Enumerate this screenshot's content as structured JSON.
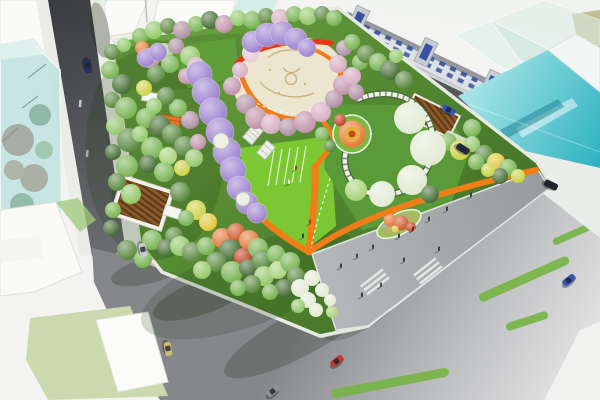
{
  "scene": {
    "type": "aerial-3d-render",
    "subject": "urban-pocket-park-masterplan-with-surrounding-streets"
  },
  "palette": {
    "background": "#f3f4f1",
    "sidewalk": "#ebece7",
    "building_white": "#fafaf8",
    "building_gray": "#c3c7ca",
    "window_blue": "#35539e",
    "glass_teal_light": "#b7e2de",
    "plaza_cream": "#ece5d0",
    "path_orange": "#f07d18",
    "path_red": "#e63614",
    "lawn_bright": "#7cc832",
    "stripe_green": "#76b544",
    "trellis_white": "#eef0e8",
    "trees": {
      "g1": "#6fae46",
      "g2": "#4e8032",
      "g3": "#8cc45e",
      "g4": "#3a6326",
      "g5": "#a4cf70",
      "y1": "#c9ce38",
      "y2": "#dfc22e",
      "o1": "#e2702a",
      "o2": "#c94e1c",
      "r1": "#bf3416",
      "p1": "#d5a6bc",
      "p2": "#bd8aa4",
      "p3": "#e6c6d6",
      "m1": "#a9879e",
      "w1": "#dfe8d0",
      "v1": "#9678cc"
    }
  },
  "park": {
    "trees": [
      [
        112,
        52,
        8,
        "g2"
      ],
      [
        124,
        45,
        7,
        "g3"
      ],
      [
        110,
        70,
        9,
        "g1"
      ],
      [
        122,
        84,
        10,
        "g4"
      ],
      [
        112,
        100,
        8,
        "g2"
      ],
      [
        126,
        108,
        11,
        "g1"
      ],
      [
        115,
        126,
        9,
        "g3"
      ],
      [
        129,
        140,
        12,
        "g2"
      ],
      [
        113,
        152,
        8,
        "g4"
      ],
      [
        127,
        166,
        11,
        "g1"
      ],
      [
        117,
        182,
        9,
        "g2"
      ],
      [
        131,
        194,
        10,
        "g3"
      ],
      [
        113,
        210,
        8,
        "g1"
      ],
      [
        111,
        228,
        8,
        "g4"
      ],
      [
        127,
        250,
        10,
        "g2"
      ],
      [
        143,
        259,
        9,
        "g1"
      ],
      [
        140,
        36,
        8,
        "g1"
      ],
      [
        154,
        30,
        9,
        "g3"
      ],
      [
        168,
        26,
        8,
        "g2"
      ],
      [
        182,
        30,
        9,
        "m1"
      ],
      [
        196,
        24,
        8,
        "g1"
      ],
      [
        210,
        20,
        9,
        "g4"
      ],
      [
        224,
        24,
        9,
        "p2"
      ],
      [
        238,
        18,
        8,
        "g3"
      ],
      [
        252,
        20,
        9,
        "g1"
      ],
      [
        266,
        16,
        8,
        "g2"
      ],
      [
        280,
        18,
        9,
        "p1"
      ],
      [
        294,
        14,
        8,
        "g1"
      ],
      [
        308,
        16,
        9,
        "g3"
      ],
      [
        322,
        14,
        8,
        "g2"
      ],
      [
        334,
        18,
        8,
        "g1"
      ],
      [
        142,
        48,
        7,
        "o1"
      ],
      [
        150,
        58,
        10,
        "p2"
      ],
      [
        164,
        52,
        9,
        "g5"
      ],
      [
        176,
        46,
        8,
        "m1"
      ],
      [
        190,
        56,
        10,
        "g3"
      ],
      [
        170,
        64,
        9,
        "g1"
      ],
      [
        156,
        74,
        9,
        "g2"
      ],
      [
        144,
        88,
        8,
        "y1"
      ],
      [
        196,
        66,
        9,
        "p1"
      ],
      [
        186,
        76,
        8,
        "p2"
      ],
      [
        146,
        118,
        10,
        "g1"
      ],
      [
        160,
        126,
        11,
        "g4"
      ],
      [
        140,
        134,
        8,
        "g3"
      ],
      [
        172,
        134,
        10,
        "g2"
      ],
      [
        152,
        148,
        11,
        "g1"
      ],
      [
        168,
        156,
        9,
        "g5"
      ],
      [
        184,
        146,
        10,
        "g2"
      ],
      [
        148,
        164,
        9,
        "g4"
      ],
      [
        164,
        172,
        10,
        "g1"
      ],
      [
        182,
        168,
        8,
        "y1"
      ],
      [
        194,
        158,
        9,
        "g3"
      ],
      [
        198,
        142,
        8,
        "p2"
      ],
      [
        190,
        120,
        9,
        "m1"
      ],
      [
        178,
        108,
        9,
        "g1"
      ],
      [
        166,
        96,
        9,
        "g2"
      ],
      [
        154,
        106,
        8,
        "g3"
      ],
      [
        180,
        192,
        10,
        "g2"
      ],
      [
        196,
        210,
        10,
        "y1"
      ],
      [
        208,
        222,
        9,
        "y2"
      ],
      [
        186,
        218,
        8,
        "g1"
      ],
      [
        174,
        236,
        9,
        "g2"
      ],
      [
        152,
        240,
        10,
        "g1"
      ],
      [
        166,
        248,
        9,
        "g4"
      ],
      [
        180,
        246,
        10,
        "g3"
      ],
      [
        192,
        252,
        10,
        "g2"
      ],
      [
        206,
        246,
        9,
        "g1"
      ],
      [
        222,
        238,
        10,
        "o1"
      ],
      [
        236,
        232,
        9,
        "o2"
      ],
      [
        249,
        240,
        10,
        "o1"
      ],
      [
        230,
        250,
        11,
        "g4"
      ],
      [
        243,
        257,
        9,
        "r1"
      ],
      [
        258,
        248,
        10,
        "g1"
      ],
      [
        216,
        262,
        10,
        "g2"
      ],
      [
        202,
        270,
        9,
        "g3"
      ],
      [
        232,
        272,
        11,
        "g1"
      ],
      [
        248,
        268,
        9,
        "g4"
      ],
      [
        262,
        260,
        10,
        "g2"
      ],
      [
        276,
        254,
        9,
        "g1"
      ],
      [
        264,
        276,
        10,
        "g3"
      ],
      [
        278,
        270,
        9,
        "g5"
      ],
      [
        252,
        284,
        9,
        "g2"
      ],
      [
        238,
        288,
        8,
        "g1"
      ],
      [
        290,
        262,
        10,
        "g1"
      ],
      [
        296,
        276,
        9,
        "g2"
      ],
      [
        284,
        288,
        9,
        "g4"
      ],
      [
        270,
        292,
        8,
        "g1"
      ],
      [
        300,
        288,
        9,
        "w1"
      ],
      [
        308,
        300,
        8,
        "w1"
      ],
      [
        298,
        306,
        7,
        "g3"
      ],
      [
        316,
        310,
        7,
        "w1"
      ],
      [
        322,
        290,
        7,
        "w1"
      ],
      [
        312,
        278,
        8,
        "w1"
      ],
      [
        330,
        300,
        6,
        "w1"
      ],
      [
        332,
        312,
        6,
        "g5"
      ],
      [
        246,
        104,
        10,
        "m1"
      ],
      [
        256,
        118,
        11,
        "p2"
      ],
      [
        271,
        124,
        10,
        "p1"
      ],
      [
        288,
        127,
        9,
        "m1"
      ],
      [
        305,
        122,
        11,
        "p2"
      ],
      [
        321,
        112,
        10,
        "p1"
      ],
      [
        334,
        99,
        9,
        "m1"
      ],
      [
        343,
        85,
        10,
        "p2"
      ],
      [
        338,
        64,
        9,
        "p1"
      ],
      [
        344,
        48,
        8,
        "m1"
      ],
      [
        251,
        53,
        9,
        "p3"
      ],
      [
        240,
        70,
        8,
        "p1"
      ],
      [
        232,
        86,
        9,
        "p2"
      ],
      [
        352,
        76,
        9,
        "p1"
      ],
      [
        360,
        62,
        8,
        "g1"
      ],
      [
        356,
        92,
        8,
        "m1"
      ],
      [
        366,
        54,
        9,
        "g2"
      ],
      [
        378,
        62,
        9,
        "g1"
      ],
      [
        390,
        70,
        10,
        "g4"
      ],
      [
        404,
        80,
        9,
        "g2"
      ],
      [
        396,
        56,
        7,
        "g3"
      ],
      [
        352,
        42,
        8,
        "g1"
      ],
      [
        472,
        128,
        9,
        "g1"
      ],
      [
        448,
        142,
        9,
        "g1"
      ],
      [
        460,
        150,
        10,
        "y1"
      ],
      [
        472,
        144,
        8,
        "g3"
      ],
      [
        484,
        154,
        9,
        "g2"
      ],
      [
        496,
        162,
        9,
        "y2"
      ],
      [
        508,
        168,
        9,
        "g1"
      ],
      [
        518,
        176,
        7,
        "y1"
      ],
      [
        500,
        176,
        8,
        "g4"
      ],
      [
        488,
        170,
        7,
        "y1"
      ],
      [
        476,
        162,
        8,
        "g1"
      ],
      [
        436,
        148,
        8,
        "g4"
      ],
      [
        410,
        118,
        16,
        "w1"
      ],
      [
        428,
        148,
        18,
        "w1"
      ],
      [
        412,
        180,
        15,
        "w1"
      ],
      [
        382,
        194,
        13,
        "w1"
      ],
      [
        356,
        190,
        11,
        "g5"
      ],
      [
        430,
        194,
        9,
        "g4"
      ],
      [
        340,
        120,
        6,
        "r1"
      ],
      [
        322,
        134,
        7,
        "g1"
      ],
      [
        330,
        146,
        6,
        "g2"
      ]
    ],
    "wisteria_tunnels": [
      {
        "name": "wisteria-tunnel-main",
        "segments": [
          [
            199,
            74,
            13
          ],
          [
            206,
            92,
            14
          ],
          [
            213,
            112,
            14
          ],
          [
            220,
            132,
            14
          ],
          [
            227,
            152,
            14
          ],
          [
            233,
            170,
            13
          ],
          [
            239,
            188,
            12
          ],
          [
            247,
            203,
            11
          ],
          [
            257,
            213,
            10
          ]
        ]
      },
      {
        "name": "wisteria-tunnel-plaza-top",
        "segments": [
          [
            253,
            42,
            11
          ],
          [
            267,
            35,
            12
          ],
          [
            282,
            33,
            12
          ],
          [
            296,
            39,
            11
          ],
          [
            307,
            48,
            9
          ]
        ]
      },
      {
        "name": "wisteria-tunnel-west",
        "segments": [
          [
            146,
            58,
            9
          ],
          [
            158,
            52,
            9
          ]
        ]
      }
    ],
    "trellis_gaps": [
      [
        221,
        141,
        8
      ],
      [
        243,
        199,
        7
      ]
    ],
    "paths": [
      {
        "name": "plaza-ring-path",
        "d": "M238,64 C246,98 264,116 292,119 C320,121 338,102 341,70",
        "width": 5,
        "color": "path_orange"
      },
      {
        "name": "red-rim-band",
        "d": "M237,63 C256,46 292,38 331,43",
        "width": 5,
        "color": "path_red"
      },
      {
        "name": "north-connector-path",
        "d": "M307,47 C322,52 334,60 341,70",
        "width": 4,
        "color": "path_orange"
      },
      {
        "name": "flowerbed-chevron-path",
        "d": "M320,116 L336,141 L315,167",
        "width": 5,
        "color": "path_orange"
      },
      {
        "name": "main-spine-path",
        "d": "M315,167 C316,196 312,224 309,252",
        "width": 7,
        "color": "path_orange"
      },
      {
        "name": "plaza-edge-path",
        "d": "M309,252 C350,222 420,196 536,170",
        "width": 6,
        "color": "path_orange"
      },
      {
        "name": "tunnel-exit-path",
        "d": "M240,197 C261,221 287,240 309,252",
        "width": 6,
        "color": "path_orange"
      }
    ],
    "lawn_stripes": [
      [
        274,
        150,
        268,
        186
      ],
      [
        282,
        149,
        276,
        185
      ],
      [
        290,
        148,
        284,
        184
      ],
      [
        298,
        147,
        292,
        183
      ],
      [
        306,
        146,
        300,
        182
      ]
    ]
  },
  "roads": {
    "green_stripes": [
      [
        390,
        383,
        120,
        9,
        -11
      ],
      [
        524,
        279,
        98,
        9,
        -24
      ],
      [
        527,
        321,
        44,
        8,
        -18
      ],
      [
        575,
        233,
        48,
        7,
        -24
      ]
    ],
    "crosswalks": [
      {
        "x": 467,
        "y": 136,
        "rot": 26,
        "bars": 4
      }
    ]
  },
  "shadows": [
    [
      300,
      334,
      85,
      22,
      -28,
      0.25
    ],
    [
      205,
      296,
      55,
      17,
      -20,
      0.28
    ],
    [
      150,
      270,
      40,
      13,
      -15,
      0.25
    ],
    [
      360,
      318,
      40,
      13,
      -30,
      0.2
    ],
    [
      470,
      95,
      80,
      10,
      26,
      0.2
    ],
    [
      360,
      55,
      45,
      8,
      26,
      0.22
    ],
    [
      100,
      30,
      28,
      9,
      80,
      0.3
    ],
    [
      120,
      200,
      20,
      8,
      80,
      0.25
    ]
  ],
  "people": [
    [
      341,
      268,
      "#2e3236"
    ],
    [
      357,
      258,
      "#5a3028"
    ],
    [
      373,
      249,
      "#2e3236"
    ],
    [
      399,
      238,
      "#2e3236"
    ],
    [
      413,
      231,
      "#44302a"
    ],
    [
      429,
      221,
      "#2e3236"
    ],
    [
      447,
      211,
      "#2e3236"
    ],
    [
      404,
      262,
      "#2e3236"
    ],
    [
      381,
      287,
      "#3a3e44"
    ],
    [
      362,
      297,
      "#2e3236"
    ],
    [
      439,
      251,
      "#2e3236"
    ],
    [
      471,
      197,
      "#2e3236"
    ],
    [
      310,
      224,
      "#b03024"
    ],
    [
      303,
      238,
      "#2e3236"
    ],
    [
      296,
      170,
      "#b03024"
    ],
    [
      289,
      184,
      "#eef0ea"
    ]
  ],
  "vehicles": [
    {
      "name": "car-sedan-red",
      "x": 337,
      "y": 361,
      "rot": -38,
      "color": "#c23a2e"
    },
    {
      "name": "car-sedan-blue",
      "x": 569,
      "y": 280,
      "rot": -38,
      "color": "#3a56b4"
    },
    {
      "name": "car-sedan-gray",
      "x": 273,
      "y": 391,
      "rot": -38,
      "color": "#8e9094"
    },
    {
      "name": "car-taxi-yellow",
      "x": 168,
      "y": 349,
      "rot": 80,
      "color": "#cdbd6a"
    },
    {
      "name": "car-sedan-silver",
      "x": 143,
      "y": 250,
      "rot": 78,
      "color": "#c9cacd"
    },
    {
      "name": "car-sedan-darkblue",
      "x": 88,
      "y": 66,
      "rot": 83,
      "color": "#23305c"
    },
    {
      "name": "car-hatch-blue",
      "x": 449,
      "y": 110,
      "rot": 26,
      "color": "#3a56b4"
    },
    {
      "name": "car-sedan-darknavy",
      "x": 463,
      "y": 149,
      "rot": 32,
      "color": "#262c3e"
    },
    {
      "name": "car-sedan-black",
      "x": 551,
      "y": 185,
      "rot": 26,
      "color": "#26262c"
    }
  ],
  "buildings": {
    "blue_row_windows": {
      "count": 16,
      "color": "window_blue"
    }
  }
}
